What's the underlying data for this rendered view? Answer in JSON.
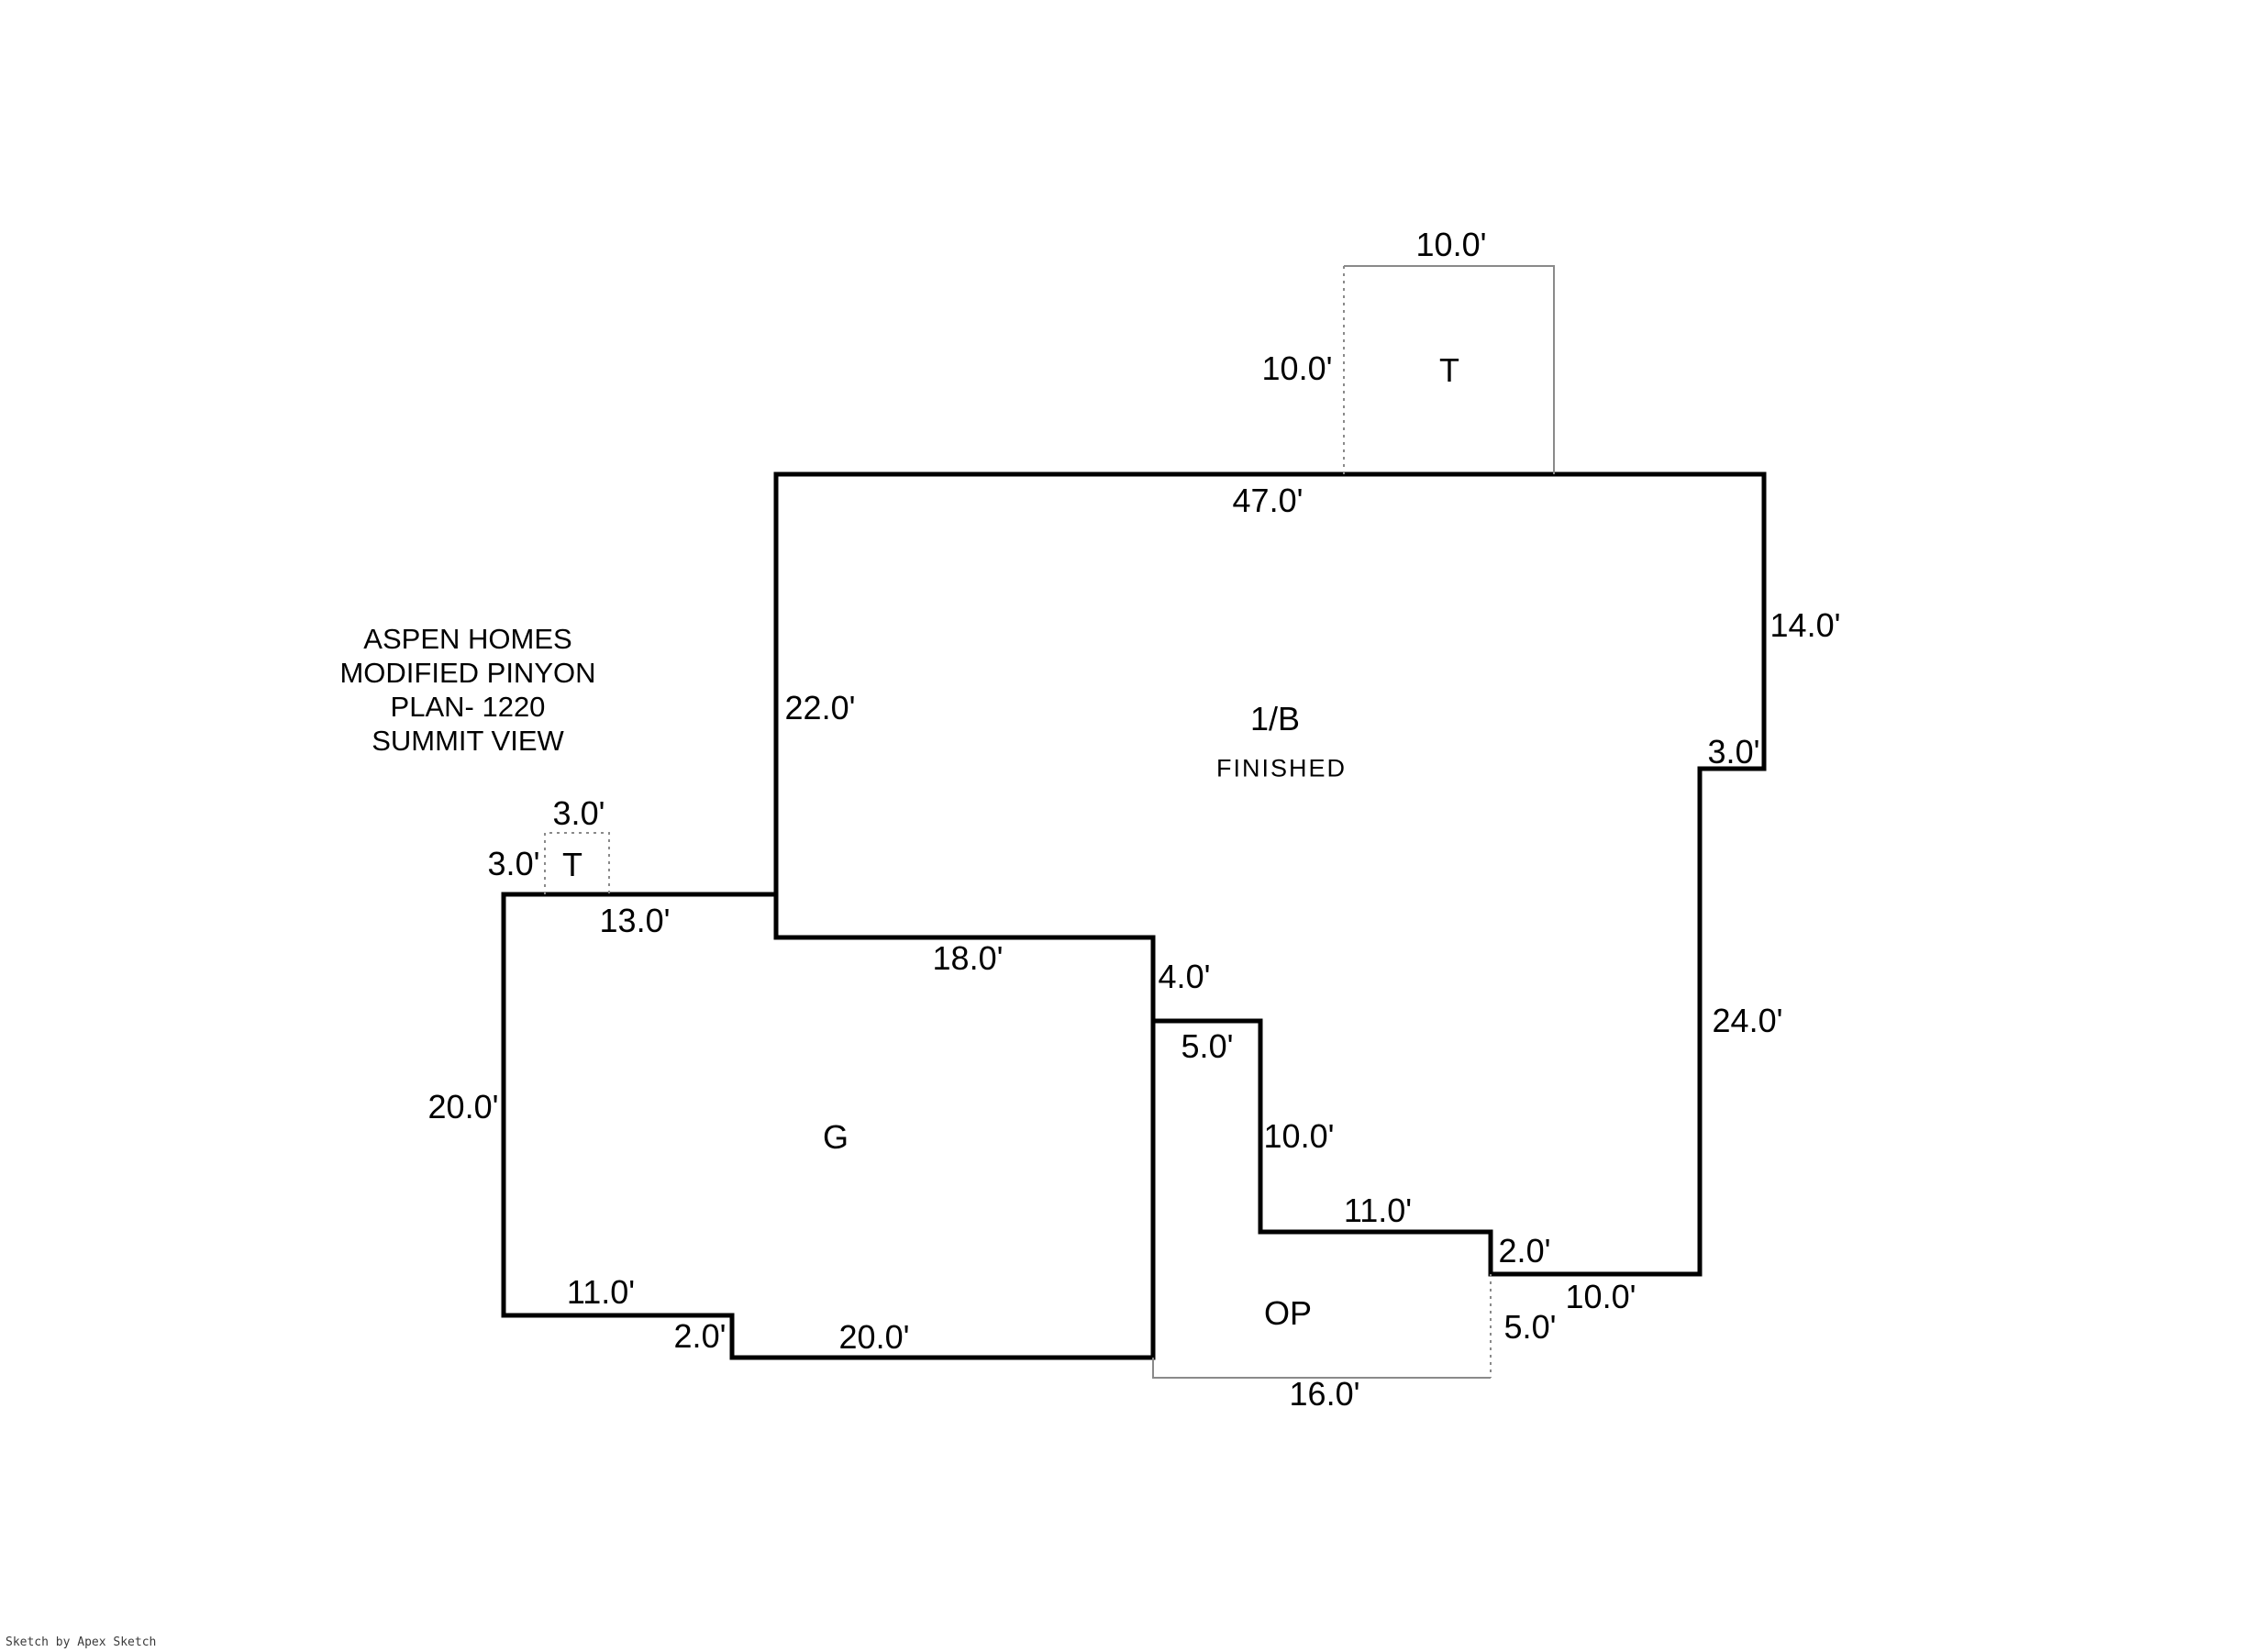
{
  "page": {
    "background": "#ffffff",
    "line_color": "#000000",
    "light_line_color": "#8a8a8a"
  },
  "title_block": {
    "lines": [
      "ASPEN HOMES",
      "MODIFIED PINYON",
      "PLAN- 1220",
      "SUMMIT VIEW"
    ]
  },
  "watermark": "Sketch by Apex Sketch",
  "areas": {
    "main": {
      "label": "1/B",
      "sublabel": "FINISHED"
    },
    "garage": {
      "label": "G"
    },
    "open_porch": {
      "label": "OP"
    },
    "tub_top": {
      "label": "T"
    },
    "tub_left": {
      "label": "T"
    }
  },
  "dimensions": {
    "t_top_width": "10.0'",
    "t_top_height": "10.0'",
    "main_top": "47.0'",
    "main_right_upper": "14.0'",
    "main_right_step": "3.0'",
    "main_left": "22.0'",
    "main_right_lower": "24.0'",
    "t_left_width": "3.0'",
    "t_left_height": "3.0'",
    "garage_top": "13.0'",
    "main_bottom_18": "18.0'",
    "step_4": "4.0'",
    "step_5": "5.0'",
    "step_10_vert": "10.0'",
    "step_11": "11.0'",
    "step_2": "2.0'",
    "bottom_right_10": "10.0'",
    "garage_left": "20.0'",
    "garage_bottom_11": "11.0'",
    "garage_bottom_step_2": "2.0'",
    "garage_bottom_20": "20.0'",
    "porch_bottom": "16.0'",
    "porch_right": "5.0'"
  }
}
